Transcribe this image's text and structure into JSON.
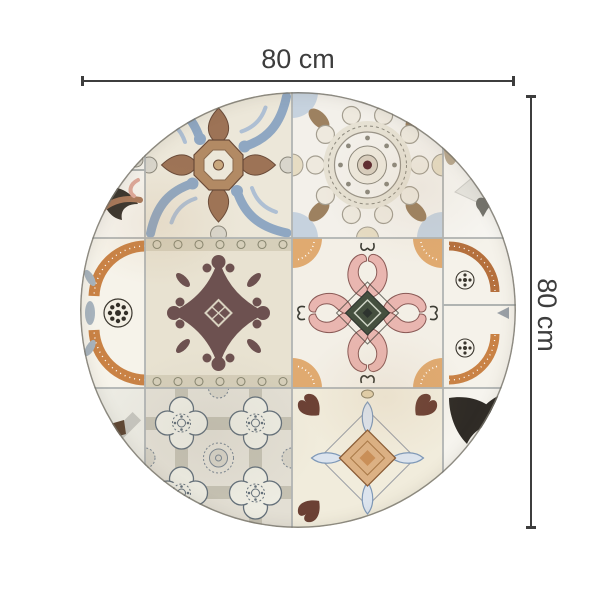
{
  "dimensions": {
    "width_label": "80 cm",
    "height_label": "80 cm"
  },
  "mat": {
    "shape": "round",
    "pattern": "patchwork of vintage azulejo tiles",
    "tiles": [
      {
        "name": "ornate-cross-blue-brown",
        "colors": [
          "#ece7d9",
          "#8fa7c2",
          "#9d7356"
        ]
      },
      {
        "name": "round-lace-medallion",
        "colors": [
          "#f3f0ea",
          "#a49e90",
          "#5d2a30",
          "#9d8160"
        ]
      },
      {
        "name": "plum-damask",
        "colors": [
          "#e8e2d1",
          "#6d5150",
          "#8a8872"
        ]
      },
      {
        "name": "pink-acanthus-cross",
        "colors": [
          "#f3efe6",
          "#e9b6b0",
          "#45503f",
          "#e0aa70"
        ]
      },
      {
        "name": "gray-quatrefoil-lattice",
        "colors": [
          "#e3dfd4",
          "#64707a",
          "#c5c1b2"
        ]
      },
      {
        "name": "diamond-leaf-medallion",
        "colors": [
          "#f1ecdc",
          "#dcb184",
          "#7f99b8",
          "#6b4034"
        ]
      },
      {
        "name": "black-leaf-edge",
        "colors": [
          "#36322c",
          "#a8785a"
        ]
      },
      {
        "name": "orange-arc-dotted-edge",
        "colors": [
          "#c98245",
          "#332f28",
          "#a7b3bd"
        ]
      },
      {
        "name": "gray-lattice-edge",
        "colors": [
          "#c0bfb8",
          "#9b9c98",
          "#5e4633"
        ]
      }
    ]
  },
  "colors": {
    "background": "#ffffff",
    "dimension_line": "#3d3d3d",
    "tile_seam": "#b0b4b2",
    "cream": "#ece7d9",
    "blue": "#8fa7c2",
    "brown": "#9d7356",
    "plum": "#6d5150",
    "pink": "#e9b6b0",
    "tan": "#e0aa70",
    "orange": "#c98245",
    "slate": "#64707a",
    "maroon": "#5d2a30",
    "black_leaf": "#2f2b26"
  }
}
